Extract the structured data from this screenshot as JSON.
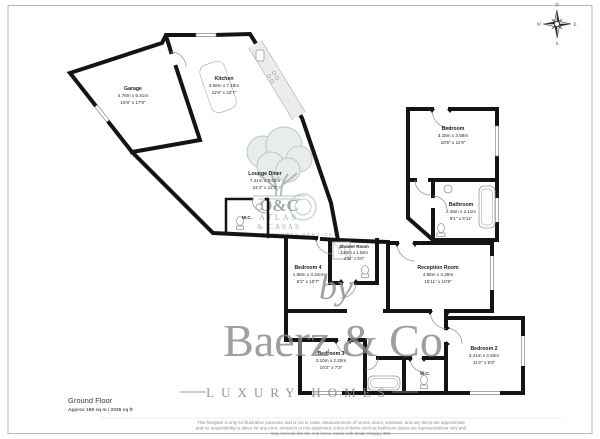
{
  "compass": {
    "n": "N",
    "e": "E",
    "s": "S",
    "w": "W"
  },
  "rooms": {
    "garage": {
      "name": "Garage",
      "metric": "4.78m x 5.41m",
      "imperial": "15'8\" x 17'9\""
    },
    "kitchen": {
      "name": "Kitchen",
      "metric": "3.56m x 7.18m",
      "imperial": "11'8\" x 23'7\""
    },
    "lounge": {
      "name": "Lounge Diner",
      "metric": "7.41m x 3.42m",
      "imperial": "24'4\" x 11'3\""
    },
    "bedroom": {
      "name": "Bedroom",
      "metric": "3.18m x 3.58m",
      "imperial": "10'5\" x 11'9\""
    },
    "bathroom": {
      "name": "Bathroom",
      "metric": "2.46m x 2.11m",
      "imperial": "8'1\" x 6'11\""
    },
    "shower": {
      "name": "Shower Room",
      "metric": "1.50m x 1.53m",
      "imperial": "4'11\" x 5'0\""
    },
    "bedroom4": {
      "name": "Bedroom 4",
      "metric": "1.88m x 3.22m",
      "imperial": "6'2\" x 10'7\""
    },
    "reception": {
      "name": "Reception Room",
      "metric": "4.86m x 3.28m",
      "imperial": "15'11\" x 10'9\""
    },
    "bedroom3": {
      "name": "Bedroom 3",
      "metric": "3.10m x 2.20m",
      "imperial": "10'2\" x 7'3\""
    },
    "bedroom2": {
      "name": "Bedroom 2",
      "metric": "3.41m x 2.83m",
      "imperial": "11'2\" x 9'3\""
    },
    "wc_hall": "W.C.",
    "wc_south": "W.C."
  },
  "watermark": {
    "monogram": "O&C",
    "line1": "ATLAS",
    "line2": "& CASAS",
    "line3": "PROPERTY SERVICES",
    "by": "by",
    "brand": "Baerz & Co",
    "tagline": "LUXURY HOMES"
  },
  "footer": {
    "floor": "Ground Floor",
    "area": "Approx 189 sq m / 2036 sq ft",
    "disclaimer1": "This floorplan is only for illustrative purposes and is not to scale. Measurements of rooms, doors, windows, and any items are approximate",
    "disclaimer2": "and no responsibility is taken for any error, omission or mis-statement. Icons of items such as bathroom suites are representations only and",
    "disclaimer3": "may not look like the real items. Made with Made Snappy 360."
  }
}
